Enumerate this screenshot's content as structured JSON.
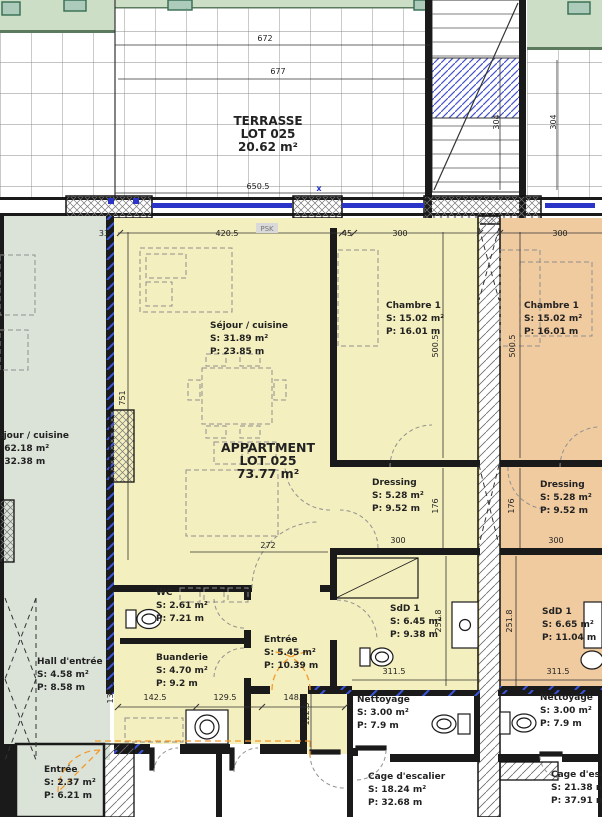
{
  "colors": {
    "apartment_yellow": "#f4efbe",
    "apartment_orange": "#f0cba0",
    "apartment_green_gray": "#dbe3d8",
    "garden_green": "#ccdec6",
    "planter_teal": "#accbba",
    "wall_black": "#1a1a1a",
    "window_blue": "#2a35c8",
    "insulation_blue": "#3a55d8",
    "door_arc_orange": "#f49a2c",
    "hatch_gray": "#8a8a8a"
  },
  "terrasse": {
    "l1": "TERRASSE",
    "l2": "LOT 025",
    "l3": "20.62 m²"
  },
  "apartment": {
    "l1": "APPARTMENT",
    "l2": "LOT 025",
    "l3": "73.77 m²"
  },
  "rooms": [
    {
      "id": "sejour-cuisine-main",
      "label": "Séjour / cuisine",
      "s": "S: 31.89 m²",
      "p": "P: 23.85 m"
    },
    {
      "id": "chambre1-main",
      "label": "Chambre 1",
      "s": "S: 15.02 m²",
      "p": "P: 16.01 m"
    },
    {
      "id": "chambre1-right",
      "label": "Chambre 1",
      "s": "S: 15.02 m²",
      "p": "P: 16.01 m"
    },
    {
      "id": "dressing-main",
      "label": "Dressing",
      "s": "S: 5.28 m²",
      "p": "P: 9.52 m"
    },
    {
      "id": "dressing-right",
      "label": "Dressing",
      "s": "S: 5.28 m²",
      "p": "P: 9.52 m"
    },
    {
      "id": "wc",
      "label": "WC",
      "s": "S: 2.61 m²",
      "p": "P: 7.21 m"
    },
    {
      "id": "buanderie",
      "label": "Buanderie",
      "s": "S: 4.70 m²",
      "p": "P: 9.2 m"
    },
    {
      "id": "entree-main",
      "label": "Entrée",
      "s": "S: 5.45 m²",
      "p": "P: 10.39 m"
    },
    {
      "id": "sdd1-main",
      "label": "SdD 1",
      "s": "S: 6.45 m²",
      "p": "P: 9.38 m"
    },
    {
      "id": "sdd1-right",
      "label": "SdD 1",
      "s": "S: 6.65 m²",
      "p": "P: 11.04 m"
    },
    {
      "id": "sejour-cuisine-left",
      "label": "Séjour / cuisine",
      "s": "S: 62.18 m²",
      "p": "P: 32.38 m"
    },
    {
      "id": "hall-entree",
      "label": "Hall d'entrée",
      "s": "S: 4.58 m²",
      "p": "P: 8.58 m"
    },
    {
      "id": "entree-left",
      "label": "Entrée",
      "s": "S: 2.37 m²",
      "p": "P: 6.21 m"
    },
    {
      "id": "nettoyage-center",
      "label": "Nettoyage",
      "s": "S: 3.00 m²",
      "p": "P: 7.9 m"
    },
    {
      "id": "cage-escalier-center",
      "label": "Cage d'escalier",
      "s": "S: 18.24 m²",
      "p": "P: 32.68 m"
    },
    {
      "id": "nettoyage-right",
      "label": "Nettoyage",
      "s": "S: 3.00 m²",
      "p": "P: 7.9 m"
    },
    {
      "id": "cage-escalier-right",
      "label": "Cage d'escalier",
      "s": "S: 21.38 m²",
      "p": "P: 37.91 m"
    }
  ],
  "dims": [
    {
      "t": "672"
    },
    {
      "t": "677"
    },
    {
      "t": "650.5"
    },
    {
      "t": "304"
    },
    {
      "t": "304"
    },
    {
      "t": "33"
    },
    {
      "t": "420.5"
    },
    {
      "t": "45"
    },
    {
      "t": "300"
    },
    {
      "t": "300"
    },
    {
      "t": "751"
    },
    {
      "t": "500.5"
    },
    {
      "t": "500.5"
    },
    {
      "t": "272"
    },
    {
      "t": "300"
    },
    {
      "t": "300"
    },
    {
      "t": "176"
    },
    {
      "t": "176"
    },
    {
      "t": "251.8"
    },
    {
      "t": "251.8"
    },
    {
      "t": "311.5"
    },
    {
      "t": "311.5"
    },
    {
      "t": "142.5"
    },
    {
      "t": "129.5"
    },
    {
      "t": "148.5"
    },
    {
      "t": "139.5"
    },
    {
      "t": "122.3"
    }
  ],
  "markers": {
    "psk": "PSK",
    "axis": "x"
  }
}
